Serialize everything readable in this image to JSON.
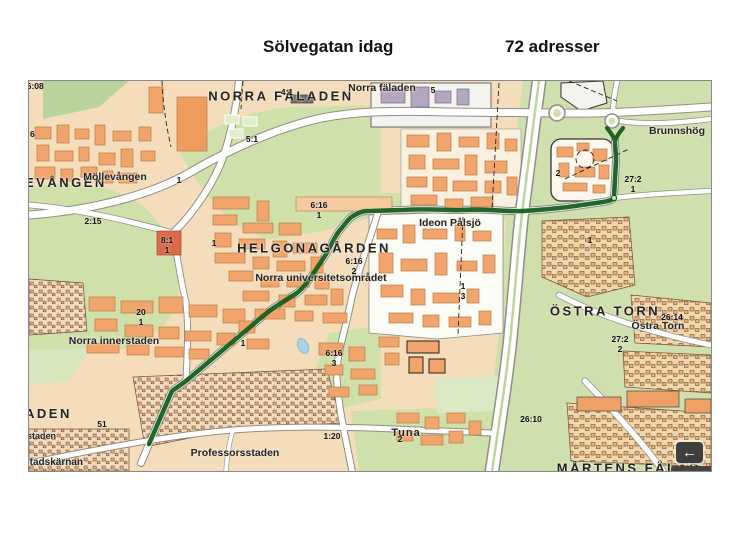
{
  "header": {
    "title_left": "Sölvegatan idag",
    "title_right": "72 adresser"
  },
  "map": {
    "districts": {
      "norra_faladen_big": "NORRA FÄLADEN",
      "norra_faladen_small": "Norra fäladen",
      "brunnshog": "Brunnshög",
      "helgonagarden": "HELGONAGÅRDEN",
      "mollevangen_clipped": "EVÅNGEN",
      "mollevangen": "Möllevången",
      "ideon_palsjo": "Ideon Pålsjö",
      "norra_universitetsomradet": "Norra universitetsområdet",
      "norra_innerstaden": "Norra innerstaden",
      "ostra_torn_big": "ÖSTRA TORN",
      "ostra_torn_small": "Östra Torn",
      "tuna": "Tuna",
      "professorsstaden": "Professorsstaden",
      "stadskarnan": "Stadskärnan",
      "staden_clipped": "staden",
      "aden_clipped": "ADEN",
      "martens_falad_clipped": "MÅRTENS FÄLAD"
    },
    "parcels": {
      "p2608": "26:08",
      "p41": "4:1",
      "p5": "5",
      "p51a": "5:1",
      "p6": "6",
      "p2": "2",
      "p272_1": "27:2\n1",
      "p616_1": "6:16\n1",
      "p616_2": "6:16\n2",
      "p616_3": "6:16\n3",
      "p13": "1\n3",
      "p1a": "1",
      "p1b": "1",
      "p1c": "1",
      "p1d": "1",
      "p81": "8:1\n1",
      "p215": "2:15",
      "p20_1": "20\n1",
      "p120": "1:20",
      "p2_tuna": "2",
      "p51": "51",
      "p2614": "26:14",
      "p272_2": "27:2\n2",
      "p2610": "26:10"
    },
    "route": {
      "color": "#155f1e"
    },
    "controls": {
      "back_glyph": "←"
    }
  }
}
